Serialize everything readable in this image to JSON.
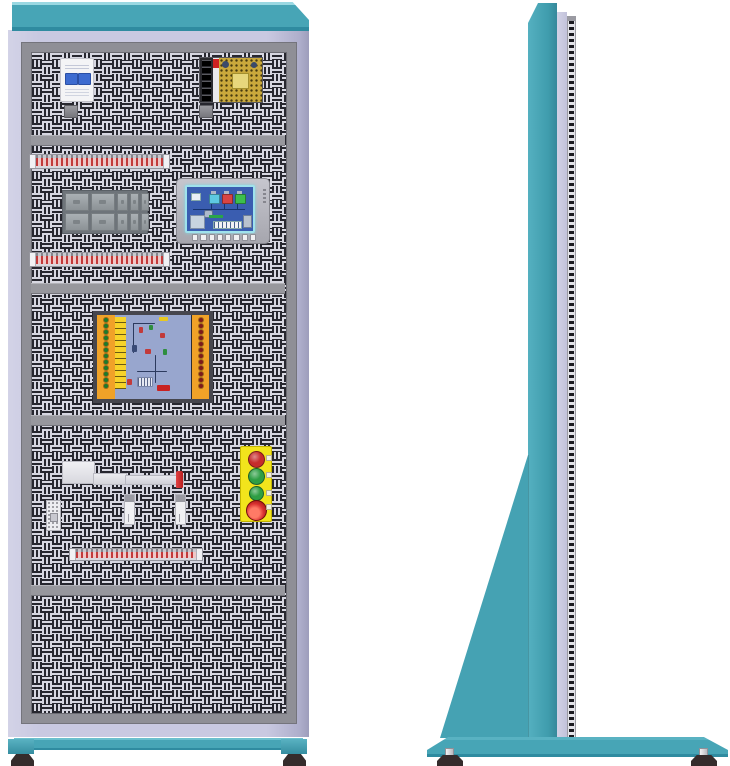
{
  "palette": {
    "teal": "#47a5b6",
    "teal_light": "#9ad8e2",
    "teal_dark": "#2f8ba0",
    "lavender": "#c9c9e1",
    "door_gray": "#8f8f96",
    "perf_light": "#d7d7e1",
    "perf_dark": "#27272f",
    "divider_gray": "#97979d",
    "din_tick_red": "#c23a3a",
    "board_orange": "#f0a228",
    "board_strip_yellow": "#f6d32a",
    "pcb_blue": "#98a6ce",
    "hmi_screen_blue": "#3a5db0",
    "hmi_frame_cyan": "#9fe2ec",
    "station_plate_yellow": "#f2e41c"
  },
  "front_view": {
    "sections": 5,
    "breaker": {
      "kind": "miniature-circuit-breaker",
      "poles": 2,
      "body_color": "#f4f4f6",
      "toggle_color": "#3d6bd0"
    },
    "power_supply": {
      "kind": "open-frame-power-supply",
      "terminal_count": 6,
      "pcb_color": "#caa93c",
      "label_color": "#cc2222"
    },
    "din_strips": {
      "count": 3,
      "tick_color": "#c23a3a"
    },
    "module_block": {
      "rows": 2,
      "cols": 5
    },
    "hmi": {
      "kind": "touch-panel-hmi",
      "function_key_count": 8,
      "indicators": [
        {
          "name": "tank-indicator-cyan",
          "color": "#5ec9e2"
        },
        {
          "name": "tank-indicator-red",
          "color": "#d84444"
        },
        {
          "name": "tank-indicator-green",
          "color": "#3cbf4e"
        }
      ]
    },
    "io_board": {
      "dot_rows": 12,
      "left_dot_color": "#1d7a2c",
      "right_dot_color": "#7d1a1a"
    },
    "button_station": {
      "plate_color": "#f2e41c",
      "buttons": [
        {
          "name": "red-push-button",
          "color": "#c62b2b",
          "size": 15
        },
        {
          "name": "green-push-button",
          "color": "#2e9e44",
          "size": 15
        },
        {
          "name": "green-push-button-small",
          "color": "#2e9e44",
          "size": 13
        },
        {
          "name": "emergency-stop-button",
          "color": "#d93030",
          "size": 19
        }
      ]
    },
    "actuator": {
      "kind": "linear-switch-handle",
      "tip_color": "#d02828"
    },
    "sensor_count": 2
  },
  "side_view": {
    "fin_stripe_dark": "#1a1a20",
    "fin_stripe_light": "#e2e2e8",
    "gusset": "triangular-support",
    "feet_count": 2
  }
}
